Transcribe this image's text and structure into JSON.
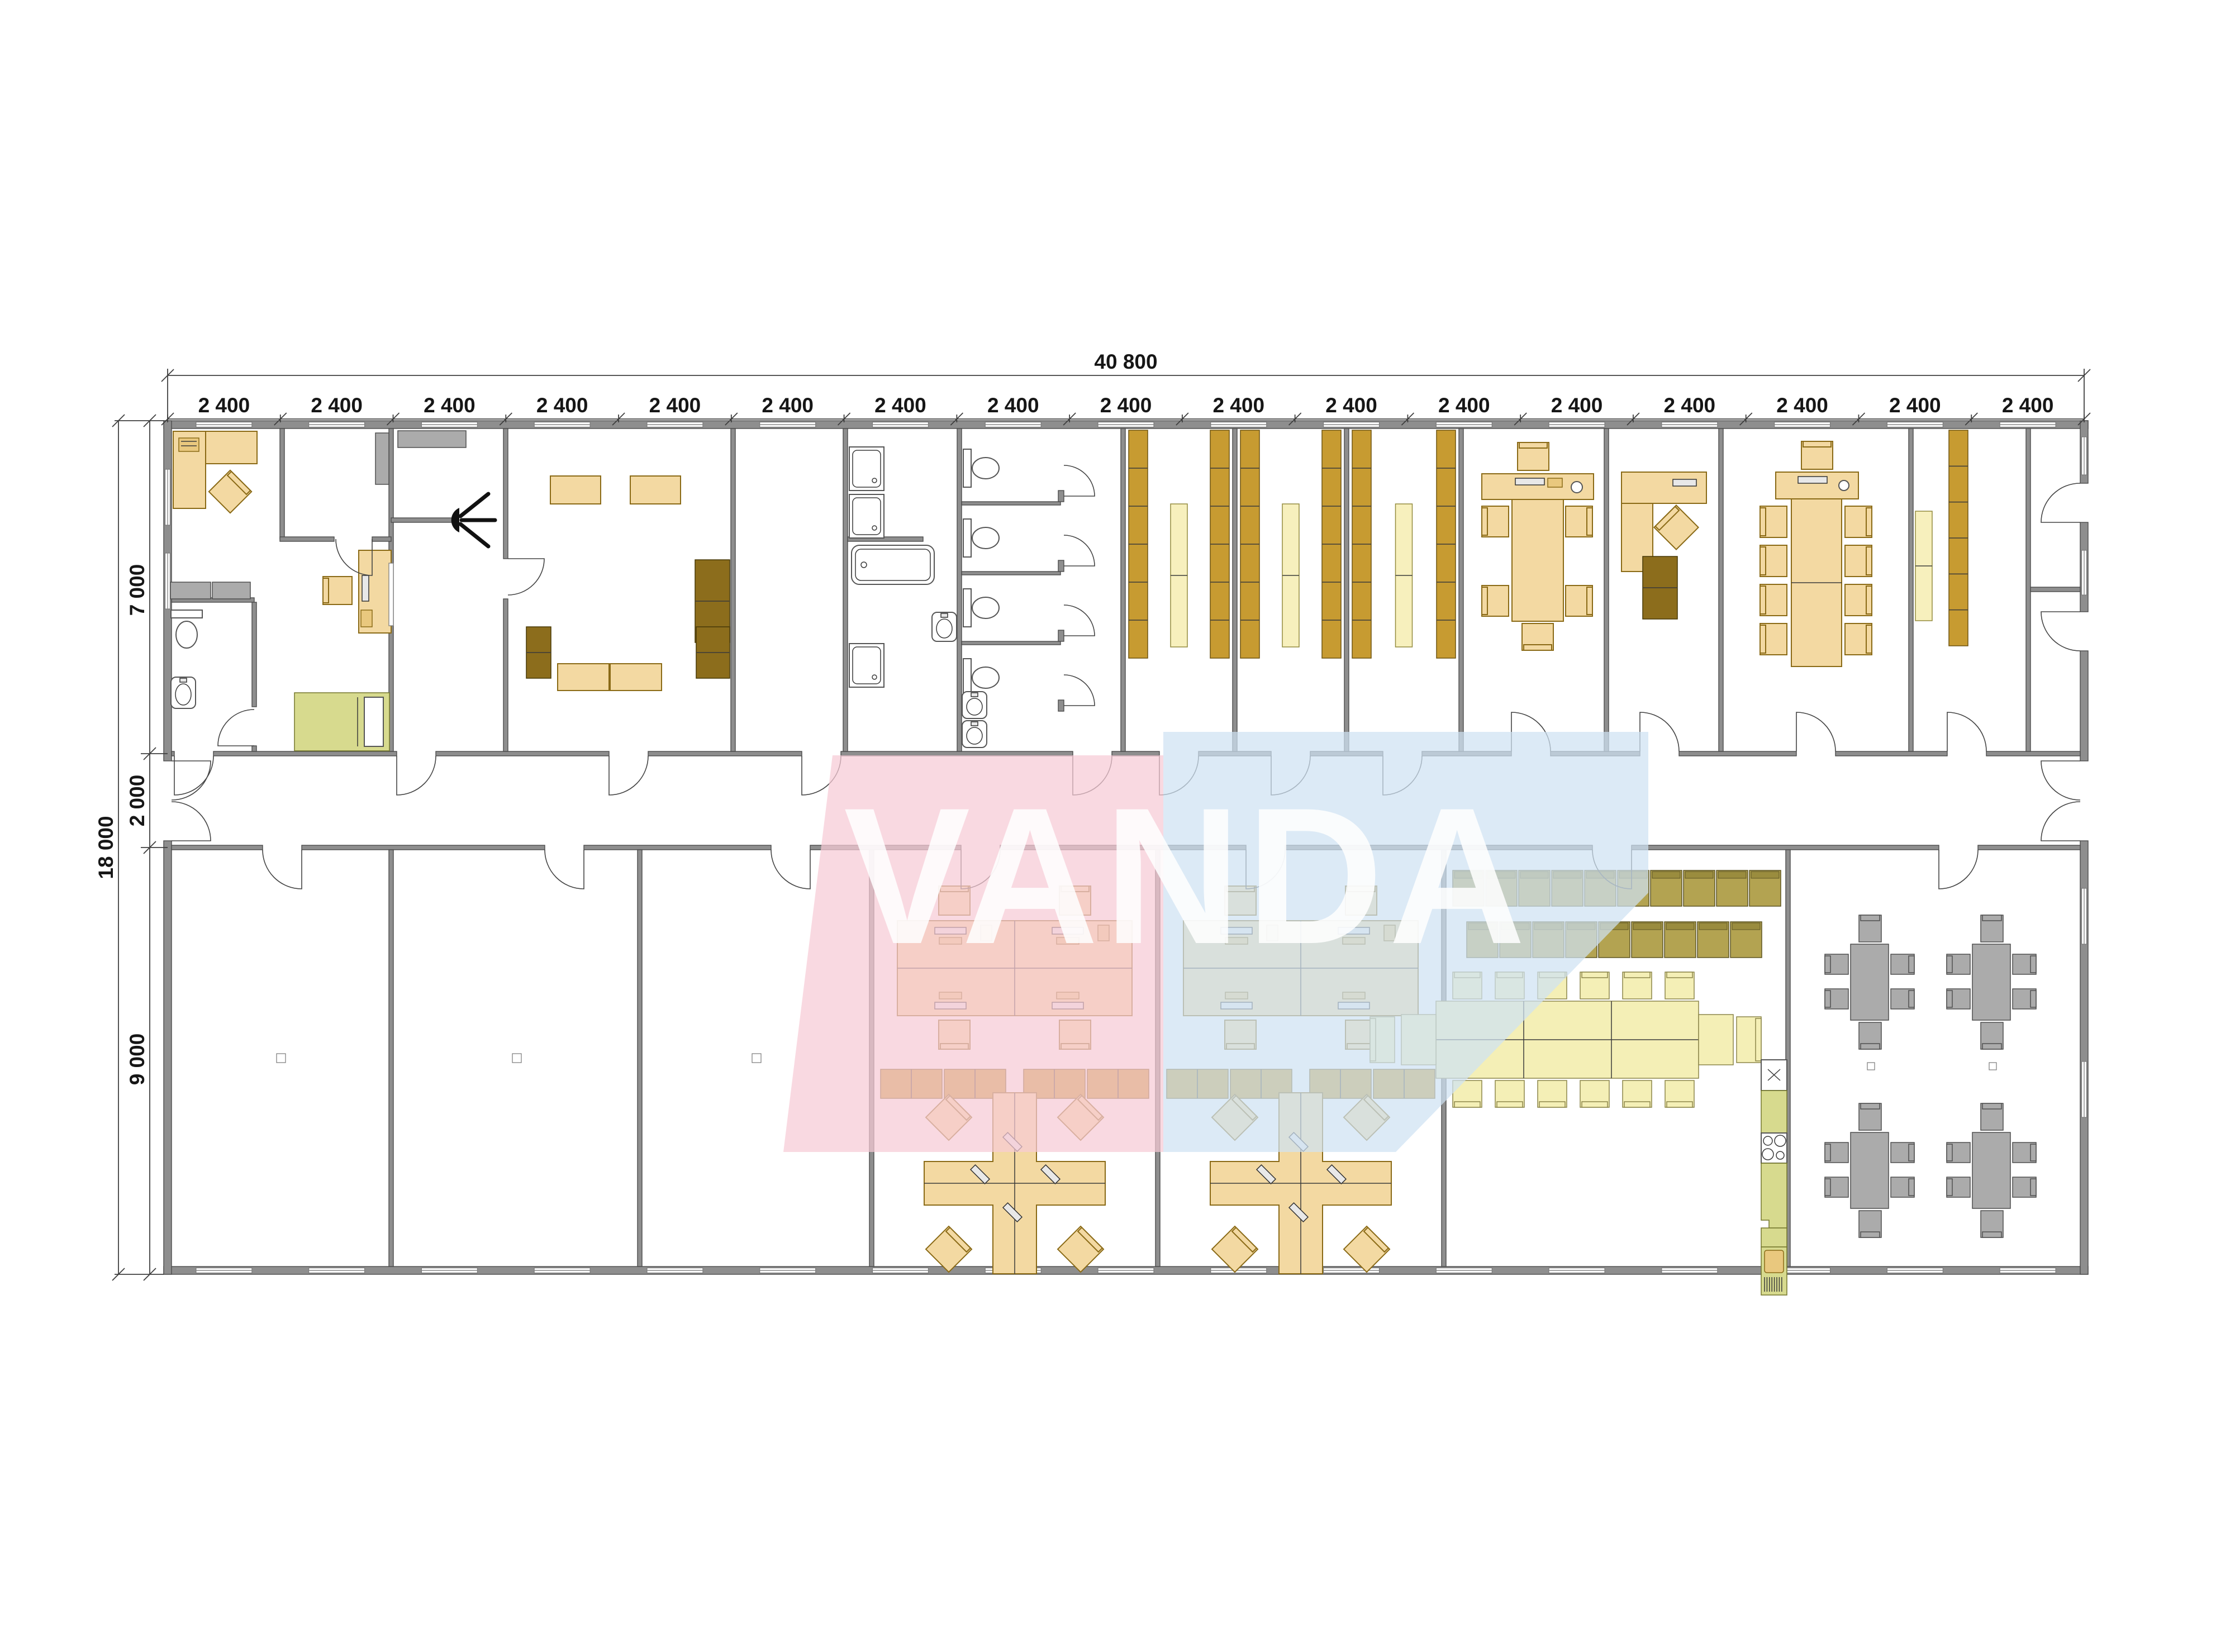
{
  "watermark": {
    "text": "VANDA",
    "pink_color": "#f6cbd5",
    "blue_color": "#cfe2f2",
    "text_color": "#ffffff"
  },
  "dimensions": {
    "top_total": "40 800",
    "modules": [
      "2 400",
      "2 400",
      "2 400",
      "2 400",
      "2 400",
      "2 400",
      "2 400",
      "2 400",
      "2 400",
      "2 400",
      "2 400",
      "2 400",
      "2 400",
      "2 400",
      "2 400",
      "2 400",
      "2 400"
    ],
    "left_total": "18 000",
    "left_segments": [
      "7 000",
      "2 000",
      "9 000"
    ]
  },
  "colors": {
    "wall": "#8e8e8e",
    "furniture_wood": "#f3d9a2",
    "shelf_gold": "#c79b31",
    "shelf_light": "#f7f0bd",
    "sofa_brown": "#8c6d1c",
    "chair_khaki": "#b3a351",
    "table_pale": "#f4efb6",
    "canteen_gray": "#ababab",
    "accent_green": "#d7da8e"
  },
  "icons": [
    "toilet-icon",
    "sink-icon",
    "shower-icon",
    "bathtub-icon",
    "bed-icon",
    "wall-light-icon",
    "desk-icon",
    "office-chair-icon",
    "monitor-icon",
    "shelf-icon",
    "cabinet-icon",
    "sofa-icon",
    "conference-table-icon",
    "stacked-chair-icon",
    "dining-table-icon",
    "kitchenette-icon",
    "stove-icon",
    "fridge-icon",
    "column-marker-icon",
    "door-swing-icon",
    "window-icon"
  ]
}
